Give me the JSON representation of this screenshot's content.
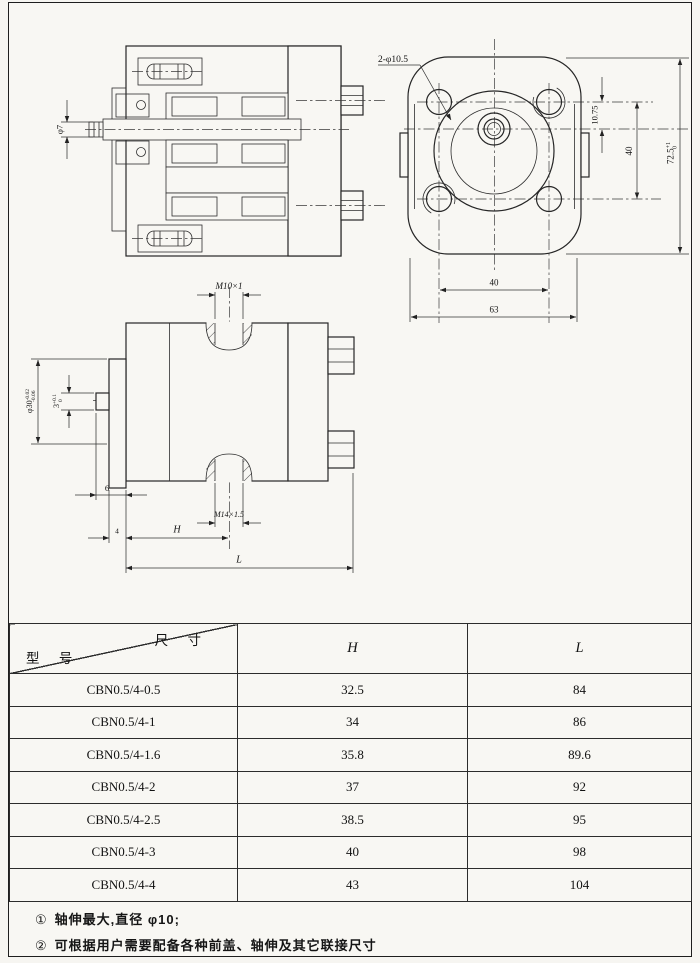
{
  "drawing": {
    "section_view": {
      "shaft_dia": "φ7"
    },
    "front_view": {
      "holes_label": "2-φ10.5",
      "offset_dim": "10.75",
      "hole_pitch_v": "40",
      "height_dim": "72.5",
      "height_tol_up": "+1",
      "height_tol_low": "0",
      "hole_pitch_h": "40",
      "width_dim": "63"
    },
    "side_view": {
      "top_port": "M10×1",
      "bottom_port": "M14×1.5",
      "spigot_dia": "φ30",
      "spigot_tol_up": "-0.02",
      "spigot_tol_low": "-0.06",
      "key_width": "3",
      "key_tol_up": "+0.1",
      "key_tol_low": "0",
      "spigot_len": "6",
      "flange_thk": "4",
      "dim_h": "H",
      "dim_l": "L"
    }
  },
  "table": {
    "corner_top_label": "尺 寸",
    "corner_bottom_label": "型 号",
    "columns": {
      "h": "H",
      "l": "L"
    },
    "rows": [
      {
        "model": "CBN0.5/4-0.5",
        "h": "32.5",
        "l": "84"
      },
      {
        "model": "CBN0.5/4-1",
        "h": "34",
        "l": "86"
      },
      {
        "model": "CBN0.5/4-1.6",
        "h": "35.8",
        "l": "89.6"
      },
      {
        "model": "CBN0.5/4-2",
        "h": "37",
        "l": "92"
      },
      {
        "model": "CBN0.5/4-2.5",
        "h": "38.5",
        "l": "95"
      },
      {
        "model": "CBN0.5/4-3",
        "h": "40",
        "l": "98"
      },
      {
        "model": "CBN0.5/4-4",
        "h": "43",
        "l": "104"
      }
    ]
  },
  "notes": [
    {
      "marker": "①",
      "text": "轴伸最大,直径 φ10;"
    },
    {
      "marker": "②",
      "text": "可根据用户需要配备各种前盖、轴伸及其它联接尺寸"
    }
  ],
  "colors": {
    "ink": "#222222",
    "paper": "#f8f7f3"
  }
}
